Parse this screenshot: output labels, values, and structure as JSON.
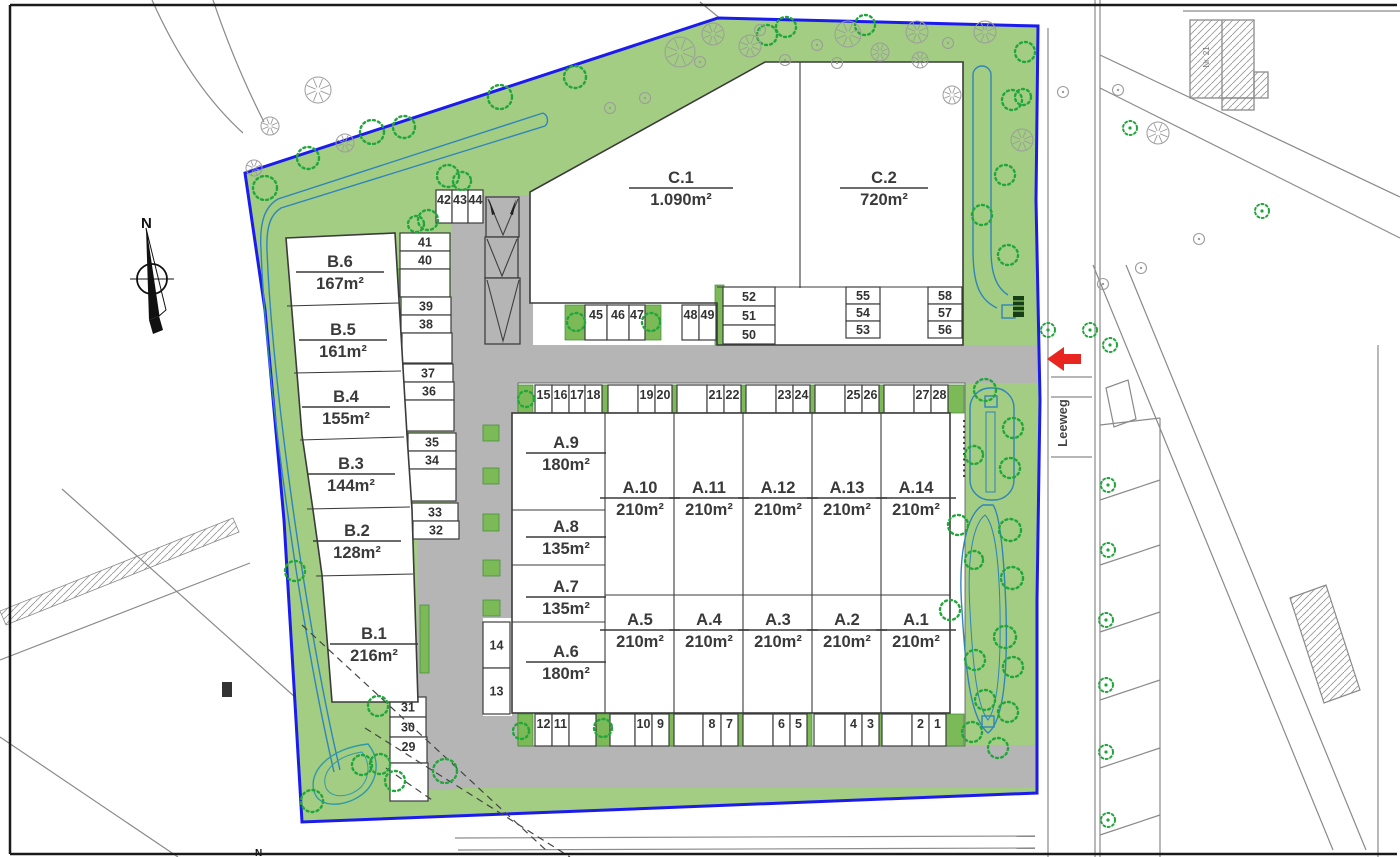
{
  "compass": {
    "label": "N"
  },
  "street_label": "Leeweg",
  "neighbor_label": "Nr. 21",
  "corner_label": "N",
  "arrow": {
    "color": "#e8251f"
  },
  "colors": {
    "site_green": "#a2cd83",
    "strip_green": "#7cba58",
    "road_gray": "#b5b5b5",
    "boundary_blue": "#1b1bee",
    "swale_blue": "#2f85bb",
    "tree_green": "#21a63c",
    "tree_gray": "#9c9c9c",
    "text": "#3a3a3a"
  },
  "units": [
    {
      "name": "B.6",
      "area": "167m²",
      "x": 340,
      "y": 272,
      "hw": 44
    },
    {
      "name": "B.5",
      "area": "161m²",
      "x": 343,
      "y": 340,
      "hw": 44
    },
    {
      "name": "B.4",
      "area": "155m²",
      "x": 346,
      "y": 407,
      "hw": 44
    },
    {
      "name": "B.3",
      "area": "144m²",
      "x": 351,
      "y": 474,
      "hw": 44
    },
    {
      "name": "B.2",
      "area": "128m²",
      "x": 357,
      "y": 541,
      "hw": 44
    },
    {
      "name": "B.1",
      "area": "216m²",
      "x": 374,
      "y": 644,
      "hw": 44
    },
    {
      "name": "C.1",
      "area": "1.090m²",
      "x": 681,
      "y": 188,
      "hw": 52
    },
    {
      "name": "C.2",
      "area": "720m²",
      "x": 884,
      "y": 188,
      "hw": 44
    },
    {
      "name": "A.9",
      "area": "180m²",
      "x": 566,
      "y": 453,
      "hw": 40
    },
    {
      "name": "A.8",
      "area": "135m²",
      "x": 566,
      "y": 537,
      "hw": 40
    },
    {
      "name": "A.7",
      "area": "135m²",
      "x": 566,
      "y": 597,
      "hw": 40
    },
    {
      "name": "A.6",
      "area": "180m²",
      "x": 566,
      "y": 662,
      "hw": 40
    },
    {
      "name": "A.10",
      "area": "210m²",
      "x": 640,
      "y": 498,
      "hw": 40
    },
    {
      "name": "A.11",
      "area": "210m²",
      "x": 709,
      "y": 498,
      "hw": 40
    },
    {
      "name": "A.12",
      "area": "210m²",
      "x": 778,
      "y": 498,
      "hw": 40
    },
    {
      "name": "A.13",
      "area": "210m²",
      "x": 847,
      "y": 498,
      "hw": 40
    },
    {
      "name": "A.14",
      "area": "210m²",
      "x": 916,
      "y": 498,
      "hw": 40
    },
    {
      "name": "A.5",
      "area": "210m²",
      "x": 640,
      "y": 630,
      "hw": 40
    },
    {
      "name": "A.4",
      "area": "210m²",
      "x": 709,
      "y": 630,
      "hw": 40
    },
    {
      "name": "A.3",
      "area": "210m²",
      "x": 778,
      "y": 630,
      "hw": 40
    },
    {
      "name": "A.2",
      "area": "210m²",
      "x": 847,
      "y": 630,
      "hw": 40
    },
    {
      "name": "A.1",
      "area": "210m²",
      "x": 916,
      "y": 630,
      "hw": 40
    }
  ],
  "stalls": [
    [
      "42",
      436,
      190,
      16,
      33
    ],
    [
      "43",
      452,
      190,
      16,
      33
    ],
    [
      "44",
      468,
      190,
      15,
      33
    ],
    [
      "41",
      400,
      233,
      50,
      18
    ],
    [
      "40",
      400,
      251,
      50,
      18
    ],
    [
      "",
      400,
      269,
      50,
      28
    ],
    [
      "39",
      401,
      297,
      50,
      18
    ],
    [
      "38",
      401,
      315,
      50,
      18
    ],
    [
      "",
      402,
      333,
      50,
      30
    ],
    [
      "37",
      403,
      364,
      50,
      18
    ],
    [
      "36",
      404,
      382,
      50,
      18
    ],
    [
      "",
      404,
      400,
      50,
      31
    ],
    [
      "35",
      408,
      433,
      48,
      18
    ],
    [
      "34",
      408,
      451,
      48,
      18
    ],
    [
      "",
      408,
      469,
      48,
      32
    ],
    [
      "33",
      412,
      503,
      46,
      18
    ],
    [
      "32",
      413,
      521,
      46,
      18
    ],
    [
      "45",
      585,
      305,
      22,
      35
    ],
    [
      "46",
      607,
      305,
      22,
      35
    ],
    [
      "47",
      629,
      305,
      16,
      35
    ],
    [
      "48",
      682,
      305,
      17,
      35
    ],
    [
      "49",
      699,
      305,
      17,
      35
    ],
    [
      "52",
      723,
      287,
      52,
      19
    ],
    [
      "51",
      723,
      306,
      52,
      19
    ],
    [
      "50",
      723,
      325,
      52,
      19
    ],
    [
      "55",
      846,
      287,
      34,
      17
    ],
    [
      "54",
      846,
      304,
      34,
      17
    ],
    [
      "53",
      846,
      321,
      34,
      17
    ],
    [
      "58",
      928,
      287,
      34,
      17
    ],
    [
      "57",
      928,
      304,
      34,
      17
    ],
    [
      "56",
      928,
      321,
      34,
      17
    ],
    [
      "15",
      535,
      385,
      17,
      28
    ],
    [
      "16",
      552,
      385,
      17,
      28
    ],
    [
      "17",
      569,
      385,
      16,
      28
    ],
    [
      "18",
      585,
      385,
      17,
      28
    ],
    [
      "",
      608,
      385,
      30,
      28
    ],
    [
      "19",
      638,
      385,
      17,
      28
    ],
    [
      "20",
      655,
      385,
      17,
      28
    ],
    [
      "",
      677,
      385,
      30,
      28
    ],
    [
      "21",
      707,
      385,
      17,
      28
    ],
    [
      "22",
      724,
      385,
      17,
      28
    ],
    [
      "",
      746,
      385,
      30,
      28
    ],
    [
      "23",
      776,
      385,
      17,
      28
    ],
    [
      "24",
      793,
      385,
      17,
      28
    ],
    [
      "",
      815,
      385,
      30,
      28
    ],
    [
      "25",
      845,
      385,
      17,
      28
    ],
    [
      "26",
      862,
      385,
      17,
      28
    ],
    [
      "",
      884,
      385,
      30,
      28
    ],
    [
      "27",
      914,
      385,
      17,
      28
    ],
    [
      "28",
      931,
      385,
      17,
      28
    ],
    [
      "12",
      535,
      714,
      17,
      32
    ],
    [
      "11",
      552,
      714,
      17,
      32
    ],
    [
      "",
      569,
      714,
      27,
      32
    ],
    [
      "",
      610,
      714,
      25,
      32
    ],
    [
      "10",
      635,
      714,
      17,
      32
    ],
    [
      "9",
      652,
      714,
      17,
      32
    ],
    [
      "",
      674,
      714,
      29,
      32
    ],
    [
      "8",
      703,
      714,
      18,
      32
    ],
    [
      "7",
      721,
      714,
      17,
      32
    ],
    [
      "",
      743,
      714,
      30,
      32
    ],
    [
      "6",
      773,
      714,
      17,
      32
    ],
    [
      "5",
      790,
      714,
      17,
      32
    ],
    [
      "",
      814,
      714,
      31,
      32
    ],
    [
      "4",
      845,
      714,
      17,
      32
    ],
    [
      "3",
      862,
      714,
      17,
      32
    ],
    [
      "",
      882,
      714,
      30,
      32
    ],
    [
      "2",
      912,
      714,
      17,
      32
    ],
    [
      "1",
      929,
      714,
      17,
      32
    ],
    [
      "14",
      483,
      622,
      27,
      46
    ],
    [
      "13",
      483,
      668,
      27,
      46
    ],
    [
      "31",
      390,
      697,
      36,
      20
    ],
    [
      "30",
      390,
      717,
      36,
      20
    ],
    [
      "29",
      390,
      737,
      37,
      26
    ],
    [
      "",
      390,
      763,
      38,
      38
    ]
  ],
  "green_strips": [
    [
      392,
      269,
      8,
      28
    ],
    [
      394,
      333,
      8,
      30
    ],
    [
      396,
      401,
      8,
      31
    ],
    [
      400,
      469,
      8,
      32
    ],
    [
      404,
      503,
      7,
      36
    ],
    [
      420,
      605,
      9,
      68
    ],
    [
      565,
      305,
      20,
      35
    ],
    [
      645,
      305,
      16,
      35
    ],
    [
      715,
      285,
      9,
      60
    ],
    [
      518,
      385,
      15,
      28
    ],
    [
      602,
      385,
      6,
      28
    ],
    [
      672,
      385,
      5,
      28
    ],
    [
      741,
      385,
      5,
      28
    ],
    [
      810,
      385,
      5,
      28
    ],
    [
      879,
      385,
      5,
      28
    ],
    [
      948,
      385,
      16,
      28
    ],
    [
      518,
      714,
      15,
      32
    ],
    [
      596,
      714,
      14,
      32
    ],
    [
      669,
      714,
      5,
      32
    ],
    [
      738,
      714,
      5,
      32
    ],
    [
      807,
      714,
      5,
      32
    ],
    [
      877,
      714,
      5,
      32
    ],
    [
      946,
      714,
      18,
      32
    ],
    [
      483,
      425,
      16,
      16
    ],
    [
      483,
      468,
      16,
      16
    ],
    [
      483,
      514,
      16,
      17
    ],
    [
      483,
      560,
      17,
      16
    ],
    [
      483,
      600,
      17,
      16
    ]
  ],
  "trees": {
    "green": [
      [
        265,
        188,
        12
      ],
      [
        308,
        158,
        11
      ],
      [
        372,
        132,
        12
      ],
      [
        404,
        127,
        11
      ],
      [
        500,
        97,
        12
      ],
      [
        575,
        77,
        11
      ],
      [
        448,
        176,
        11
      ],
      [
        462,
        181,
        9
      ],
      [
        428,
        220,
        10
      ],
      [
        416,
        224,
        8
      ],
      [
        767,
        35,
        10
      ],
      [
        786,
        27,
        10
      ],
      [
        865,
        25,
        10
      ],
      [
        1025,
        52,
        10
      ],
      [
        1012,
        100,
        10
      ],
      [
        1023,
        97,
        8
      ],
      [
        1005,
        175,
        10
      ],
      [
        982,
        215,
        10
      ],
      [
        1008,
        255,
        10
      ],
      [
        295,
        571,
        10
      ],
      [
        378,
        706,
        10
      ],
      [
        380,
        764,
        10
      ],
      [
        445,
        771,
        12
      ],
      [
        395,
        781,
        10
      ],
      [
        312,
        801,
        11
      ],
      [
        362,
        765,
        10
      ],
      [
        576,
        322,
        9
      ],
      [
        651,
        322,
        9
      ],
      [
        526,
        399,
        8
      ],
      [
        603,
        728,
        9
      ],
      [
        521,
        731,
        8
      ],
      [
        985,
        390,
        11
      ],
      [
        1013,
        428,
        10
      ],
      [
        974,
        455,
        9
      ],
      [
        1010,
        468,
        10
      ],
      [
        958,
        525,
        10
      ],
      [
        1010,
        530,
        11
      ],
      [
        974,
        560,
        9
      ],
      [
        1012,
        578,
        11
      ],
      [
        950,
        610,
        10
      ],
      [
        1005,
        637,
        11
      ],
      [
        975,
        660,
        10
      ],
      [
        1013,
        667,
        10
      ],
      [
        985,
        700,
        10
      ],
      [
        1008,
        712,
        10
      ],
      [
        972,
        732,
        10
      ],
      [
        998,
        748,
        10
      ]
    ],
    "green_dot": [
      [
        1048,
        330
      ],
      [
        1090,
        330
      ],
      [
        1110,
        345
      ],
      [
        1130,
        128
      ],
      [
        1262,
        211
      ],
      [
        1108,
        485
      ],
      [
        1108,
        550
      ],
      [
        1106,
        620
      ],
      [
        1106,
        685
      ],
      [
        1106,
        752
      ],
      [
        1108,
        820
      ]
    ],
    "gray_radial": [
      [
        318,
        90,
        13
      ],
      [
        270,
        126,
        9
      ],
      [
        345,
        143,
        9
      ],
      [
        254,
        168,
        8
      ],
      [
        680,
        52,
        15
      ],
      [
        713,
        34,
        11
      ],
      [
        750,
        46,
        11
      ],
      [
        848,
        34,
        13
      ],
      [
        917,
        32,
        11
      ],
      [
        985,
        32,
        11
      ],
      [
        880,
        52,
        9
      ],
      [
        920,
        60,
        8
      ],
      [
        1022,
        140,
        11
      ],
      [
        1158,
        133,
        11
      ],
      [
        952,
        95,
        9
      ]
    ],
    "gray_dot": [
      [
        610,
        108
      ],
      [
        645,
        98
      ],
      [
        817,
        45
      ],
      [
        948,
        43
      ],
      [
        837,
        63
      ],
      [
        700,
        62
      ],
      [
        785,
        60
      ],
      [
        760,
        30
      ],
      [
        1063,
        92
      ],
      [
        1118,
        90
      ],
      [
        1103,
        284
      ],
      [
        1141,
        268
      ],
      [
        1199,
        239
      ]
    ]
  }
}
